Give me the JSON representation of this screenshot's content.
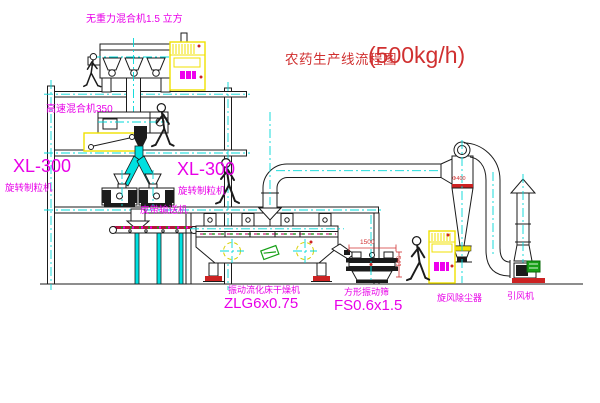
{
  "title": {
    "text": "农药生产线流程图",
    "capacity": "(500kg/h)"
  },
  "labels": {
    "gravity_mixer": "无重力混合机1.5 立方",
    "highspeed_mixer": "高速混合机350",
    "granulator_left_model": "XL-300",
    "granulator_left_name": "旋转制粒机",
    "granulator_right_model": "XL-300",
    "granulator_right_name": "旋转制粒机",
    "belt_conveyor": "皮带输送机",
    "dryer_name": "振动流化床干燥机",
    "dryer_model": "ZLG6x0.75",
    "sieve_name": "方形振动筛",
    "sieve_model": "FS0.6x1.5",
    "cyclone_name": "旋风除尘器",
    "fan_name": "引风机"
  },
  "dimensions": {
    "sieve_width": "1500",
    "sieve_height": "541",
    "cyclone_dia": "Φ400"
  },
  "colors": {
    "magenta": "#ee00ee",
    "red": "#d03030",
    "cyan": "#00d8d8",
    "yellow": "#f0e000",
    "green": "#17a017",
    "line": "#1b1b1b"
  }
}
